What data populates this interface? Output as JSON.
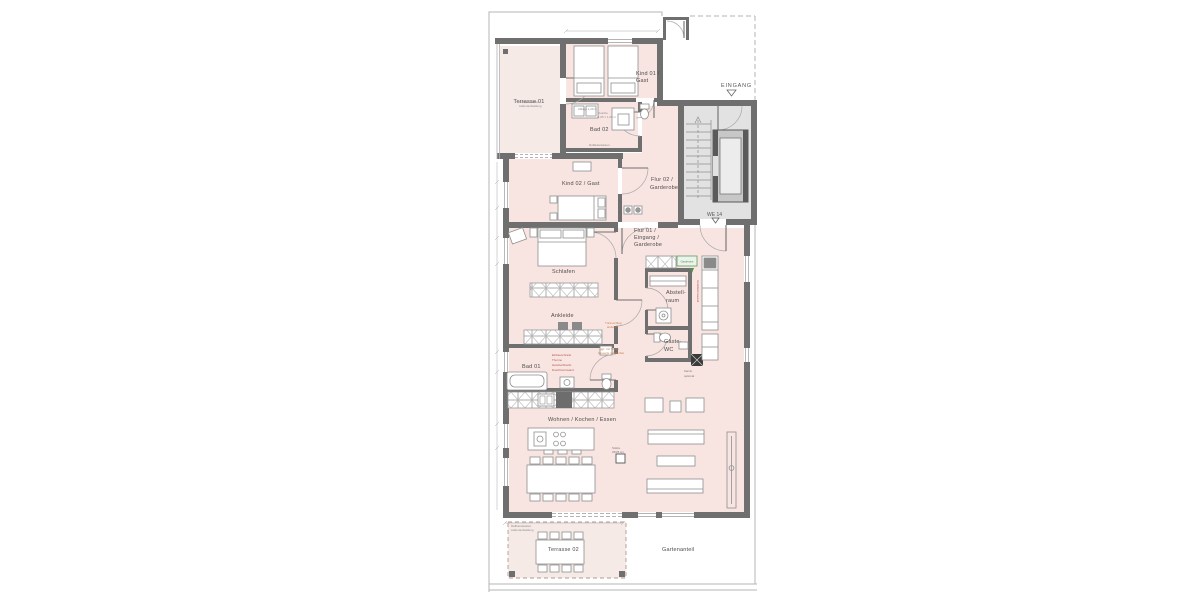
{
  "plan_title": "floor-plan",
  "labels": {
    "terrasse01": "Terrasse 01",
    "kind01_1": "Kind 01 /",
    "kind01_2": "Gast",
    "bad02": "Bad 02",
    "kind02": "Kind 02 / Gast",
    "flur02_1": "Flur 02 /",
    "flur02_2": "Garderobe",
    "flur01_1": "Flur 01 /",
    "flur01_2": "Eingang /",
    "flur01_3": "Garderobe",
    "schlafen": "Schlafen",
    "ankleide": "Ankleide",
    "bad01": "Bad 01",
    "wohnen": "Wohnen / Kochen / Essen",
    "abstell_1": "Abstell-",
    "abstell_2": "raum",
    "gaestewc_1": "Gäste-",
    "gaestewc_2": "WC",
    "kamin_1": "Kamin",
    "kamin_2": "optional",
    "terrasse02": "Terrasse 02",
    "gartenanteil": "Gartenanteil",
    "eingang": "EINGANG",
    "we": "WE 14"
  },
  "annotations": {
    "raffstore_1": "Raffstorekasten",
    "raffstore_2": "Außenaufstellung",
    "ablage": "Ablage 1,20 m",
    "dusche_1": "Dusche",
    "dusche_2": "1,05 × 1,05 m",
    "rollladen": "Rollladenkasten",
    "tuer_1": "Türanschlag",
    "tuer_2": "ändern",
    "theke_1": "ggf. mit Theke",
    "theke_2": "bauseits möblierbar",
    "bad01note_1": "Einbauschrank",
    "bad01note_2": "Therme",
    "bad01note_3": "Handtuchheizk.",
    "bad01note_4": "Duschtrennwand",
    "install": "Installationswand",
    "garderobe_box": "Garderobe",
    "stuetze_1": "Stütze",
    "stuetze_2": "25/25 cm"
  },
  "colors": {
    "wall": "#6f6f6f",
    "interior_pink": "#f8e5e1",
    "terrace_pink": "#f6eae6",
    "stair_floor": "#e2e2e2",
    "annotation_orange": "#c8824f",
    "annotation_red": "#b4534f",
    "annotation_green": "#4f8f4f",
    "boundary": "#b5b5b5"
  }
}
